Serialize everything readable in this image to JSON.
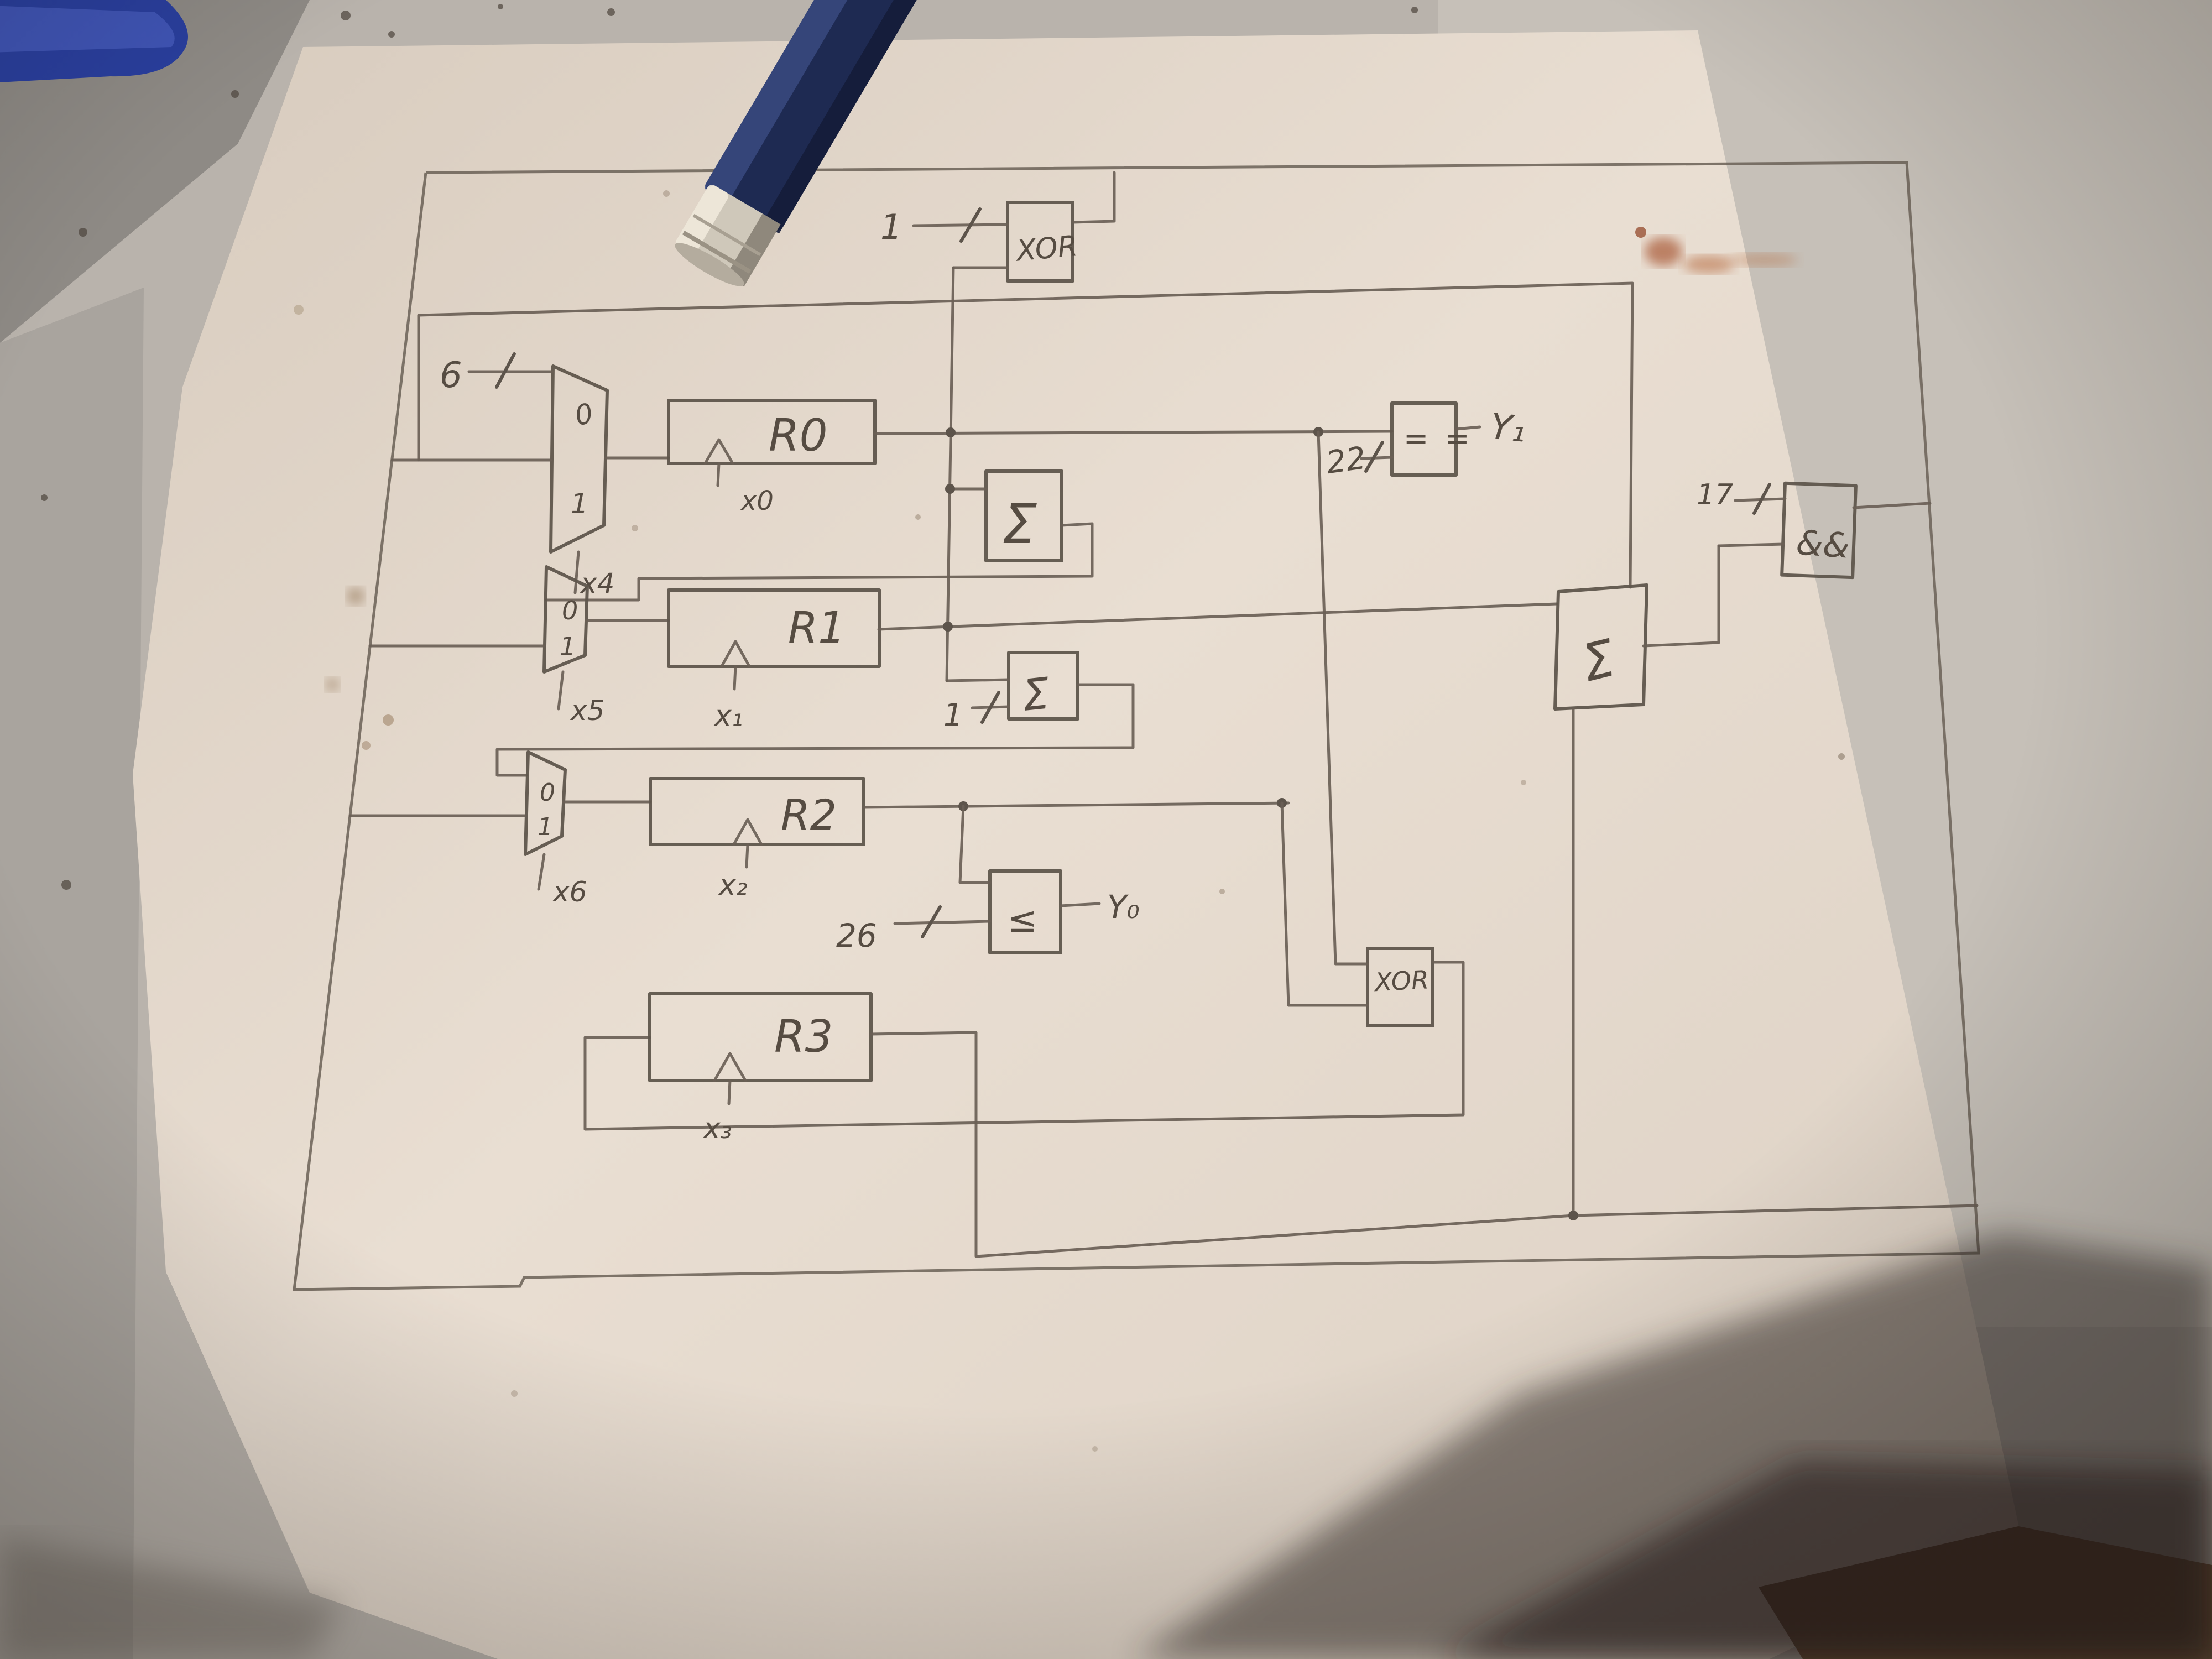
{
  "title": "hand-drawn register datapath schematic photo",
  "gates": {
    "xor_top": "XOR",
    "xor_right": "XOR",
    "and_gate": "&&",
    "equals": "= =",
    "less_equal": "≤",
    "sigma_top": "Σ",
    "sigma_mid": "Σ",
    "sigma_right": "Σ"
  },
  "registers": {
    "r0": "R0",
    "r1": "R1",
    "r2": "R2",
    "r3": "R3"
  },
  "enables": {
    "x0": "x0",
    "x1": "x₁",
    "x2": "x₂",
    "x3": "x₃"
  },
  "mux_selects": {
    "x4": "x4",
    "x5": "x5",
    "x6": "x6"
  },
  "mux_ports": {
    "m1_0": "0",
    "m1_1": "1",
    "m2_0": "0",
    "m2_1": "1",
    "m3_0": "0",
    "m3_1": "1"
  },
  "constants": {
    "xor_in": "1",
    "mux1_in": "6",
    "sum_in": "1",
    "eq_in": "22",
    "le_in": "26",
    "and_in": "17"
  },
  "outputs": {
    "y0": "Y₀",
    "y1": "Y₁"
  },
  "colors": {
    "paper": "#e9ded2",
    "desk": "#b9b3ac",
    "tile": "#8e8a85",
    "pencil_line": "#6a6056",
    "pencil_body_blue": "#1e2a52",
    "ferrule_silver": "#cfc8ba",
    "handle_blue": "#2a3f9e",
    "shadow": "#2f2620",
    "stain_rust": "#a4502a"
  }
}
